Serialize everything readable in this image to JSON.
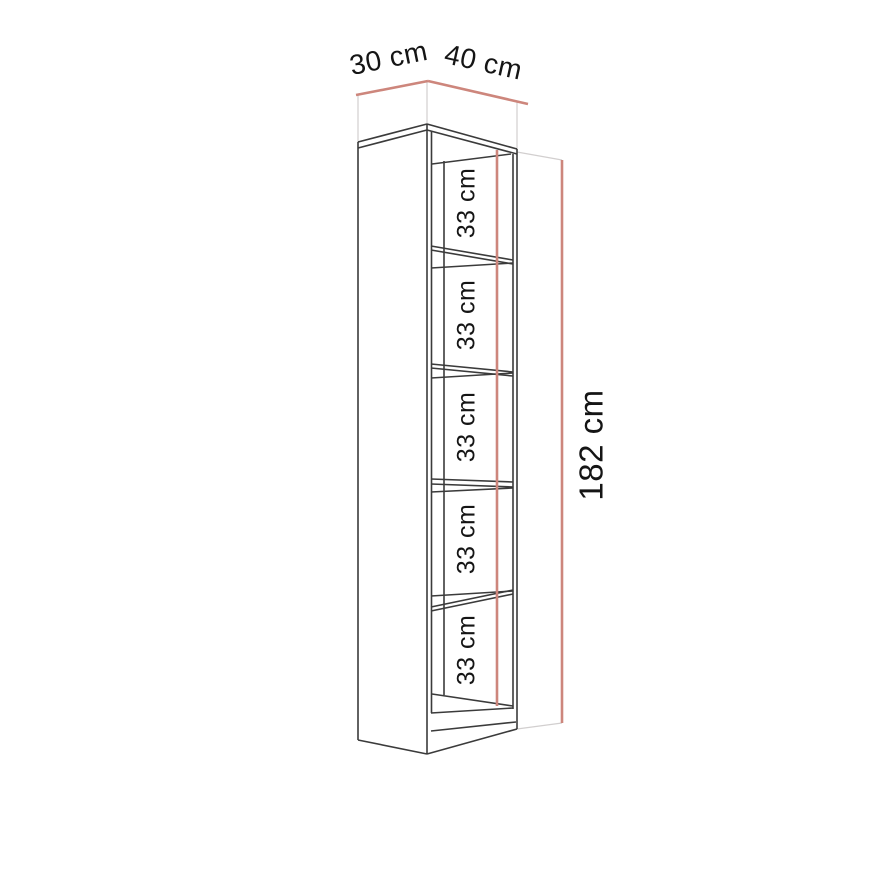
{
  "title": "Bookcase dimension diagram",
  "dimensions": {
    "depth_label": "30 cm",
    "width_label": "40 cm",
    "height_label": "182 cm",
    "shelf_labels": [
      "33 cm",
      "33 cm",
      "33 cm",
      "33 cm",
      "33 cm"
    ]
  },
  "colors": {
    "background": "#ffffff",
    "outline": "#3b3b3b",
    "dimension": "#cd867c",
    "extension": "#d2cfcf",
    "text": "#151515"
  },
  "drawing": {
    "lines": [
      {
        "role": "ext",
        "x1": 358,
        "y1": 95,
        "x2": 358,
        "y2": 143
      },
      {
        "role": "ext",
        "x1": 427,
        "y1": 81,
        "x2": 427,
        "y2": 125
      },
      {
        "role": "ext",
        "x1": 517,
        "y1": 102,
        "x2": 517,
        "y2": 150
      },
      {
        "role": "ext",
        "x1": 517,
        "y1": 152,
        "x2": 562,
        "y2": 160
      },
      {
        "role": "ext",
        "x1": 517,
        "y1": 729,
        "x2": 562,
        "y2": 723
      },
      {
        "role": "main",
        "x1": 358,
        "y1": 142,
        "x2": 358,
        "y2": 740
      },
      {
        "role": "main",
        "x1": 358,
        "y1": 142,
        "x2": 427,
        "y2": 124
      },
      {
        "role": "main",
        "x1": 358,
        "y1": 148,
        "x2": 427,
        "y2": 130
      },
      {
        "role": "main",
        "x1": 358,
        "y1": 740,
        "x2": 427,
        "y2": 754
      },
      {
        "role": "main",
        "x1": 427,
        "y1": 124,
        "x2": 427,
        "y2": 754
      },
      {
        "role": "main",
        "x1": 431.5,
        "y1": 131,
        "x2": 431.5,
        "y2": 713
      },
      {
        "role": "main",
        "x1": 444,
        "y1": 161,
        "x2": 444,
        "y2": 695
      },
      {
        "role": "main",
        "x1": 517,
        "y1": 149,
        "x2": 517,
        "y2": 729
      },
      {
        "role": "main",
        "x1": 513,
        "y1": 154,
        "x2": 513,
        "y2": 709
      },
      {
        "role": "main",
        "x1": 427,
        "y1": 124,
        "x2": 517,
        "y2": 149
      },
      {
        "role": "main",
        "x1": 427,
        "y1": 130,
        "x2": 517,
        "y2": 154
      },
      {
        "role": "main",
        "x1": 432,
        "y1": 164,
        "x2": 511,
        "y2": 154
      },
      {
        "role": "main",
        "x1": 431,
        "y1": 246,
        "x2": 513,
        "y2": 260
      },
      {
        "role": "main",
        "x1": 431,
        "y1": 250,
        "x2": 513,
        "y2": 264
      },
      {
        "role": "main",
        "x1": 431,
        "y1": 268,
        "x2": 513,
        "y2": 263
      },
      {
        "role": "main",
        "x1": 431,
        "y1": 364,
        "x2": 513,
        "y2": 372
      },
      {
        "role": "main",
        "x1": 431,
        "y1": 368,
        "x2": 513,
        "y2": 376
      },
      {
        "role": "main",
        "x1": 431,
        "y1": 378,
        "x2": 513,
        "y2": 373
      },
      {
        "role": "main",
        "x1": 431,
        "y1": 479,
        "x2": 513,
        "y2": 482
      },
      {
        "role": "main",
        "x1": 431,
        "y1": 484,
        "x2": 513,
        "y2": 487
      },
      {
        "role": "main",
        "x1": 431,
        "y1": 492,
        "x2": 513,
        "y2": 488
      },
      {
        "role": "main",
        "x1": 431,
        "y1": 607,
        "x2": 513,
        "y2": 590
      },
      {
        "role": "main",
        "x1": 431,
        "y1": 611,
        "x2": 513,
        "y2": 594
      },
      {
        "role": "main",
        "x1": 431,
        "y1": 596,
        "x2": 513,
        "y2": 591
      },
      {
        "role": "main",
        "x1": 432,
        "y1": 694,
        "x2": 513,
        "y2": 706
      },
      {
        "role": "main",
        "x1": 431,
        "y1": 713,
        "x2": 513,
        "y2": 708
      },
      {
        "role": "main",
        "x1": 431,
        "y1": 731,
        "x2": 516,
        "y2": 722
      },
      {
        "role": "main",
        "x1": 427,
        "y1": 754,
        "x2": 517,
        "y2": 729
      },
      {
        "role": "dim",
        "x1": 356,
        "y1": 95,
        "x2": 428,
        "y2": 81
      },
      {
        "role": "dim",
        "x1": 428,
        "y1": 81,
        "x2": 528,
        "y2": 104
      },
      {
        "role": "dim",
        "x1": 497,
        "y1": 150,
        "x2": 497,
        "y2": 706
      },
      {
        "role": "dim",
        "x1": 562,
        "y1": 160,
        "x2": 562,
        "y2": 723
      }
    ],
    "labels": [
      {
        "name": "depth-dimension-label",
        "path": "dimensions.depth_label",
        "x": 389,
        "y": 60,
        "rotate": -11.5,
        "size": 28
      },
      {
        "name": "width-dimension-label",
        "path": "dimensions.width_label",
        "x": 483,
        "y": 64,
        "rotate": 12.5,
        "size": 28
      },
      {
        "name": "height-dimension-label",
        "path": "dimensions.height_label",
        "x": 594,
        "y": 445,
        "rotate": -90,
        "size": 33
      },
      {
        "name": "shelf-dimension-label-1",
        "path": "dimensions.shelf_labels.0",
        "x": 468,
        "y": 203,
        "rotate": -90,
        "size": 25
      },
      {
        "name": "shelf-dimension-label-2",
        "path": "dimensions.shelf_labels.1",
        "x": 468,
        "y": 315,
        "rotate": -90,
        "size": 25
      },
      {
        "name": "shelf-dimension-label-3",
        "path": "dimensions.shelf_labels.2",
        "x": 468,
        "y": 427,
        "rotate": -90,
        "size": 25
      },
      {
        "name": "shelf-dimension-label-4",
        "path": "dimensions.shelf_labels.3",
        "x": 468,
        "y": 539,
        "rotate": -90,
        "size": 25
      },
      {
        "name": "shelf-dimension-label-5",
        "path": "dimensions.shelf_labels.4",
        "x": 468,
        "y": 650,
        "rotate": -90,
        "size": 25
      }
    ]
  }
}
